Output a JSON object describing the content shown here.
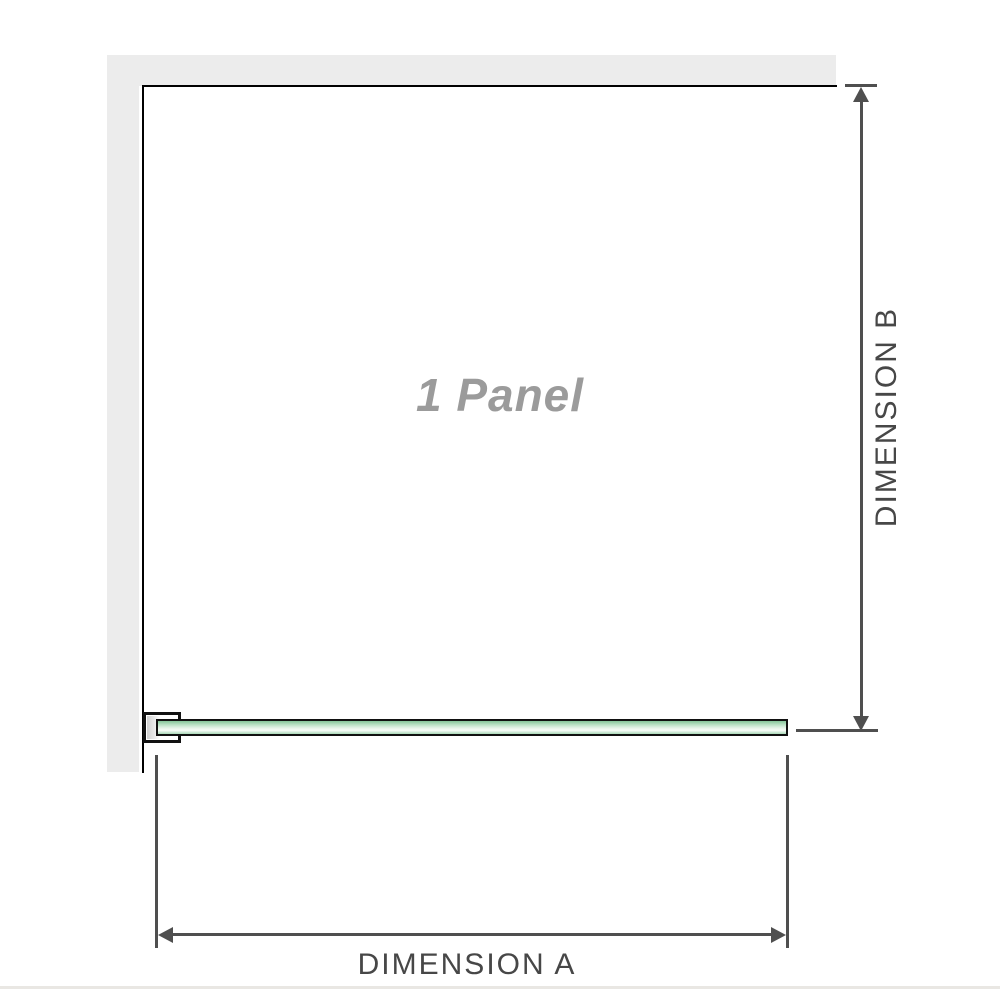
{
  "labels": {
    "panel": "1 Panel",
    "dimension_a": "DIMENSION A",
    "dimension_b": "DIMENSION B"
  },
  "colors": {
    "wall": "#ececec",
    "panel_outline": "#000000",
    "dimension_line": "#4f4f4f",
    "dimension_text": "#474747",
    "panel_label_text": "#9b9b9b",
    "glass_border": "#111111",
    "glass_green": "#9ed2ad",
    "glass_highlight": "#f4fbf5",
    "bottom_divider": "#e9e7e3"
  }
}
